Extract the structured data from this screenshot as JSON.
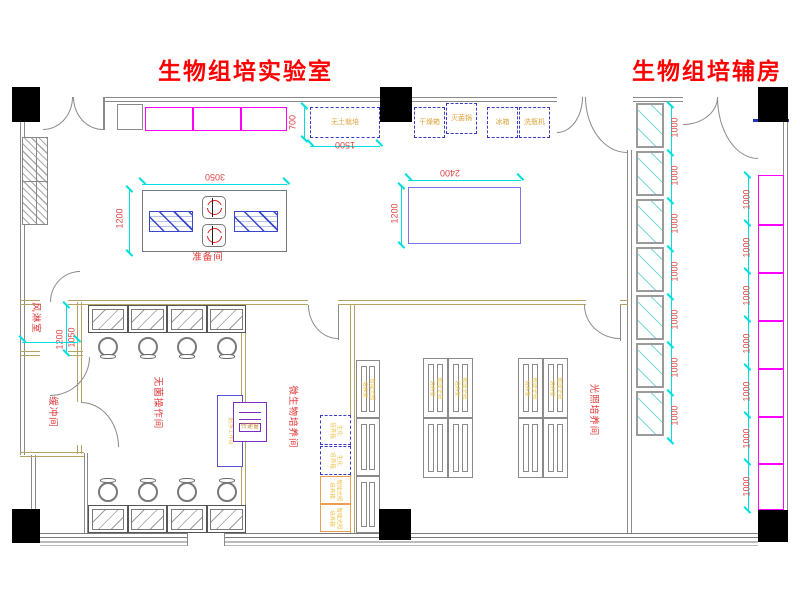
{
  "titles": {
    "main_lab": "生物组培实验室",
    "aux_room": "生物组培辅房"
  },
  "rooms": {
    "prep_room": "准备间",
    "air_shower": "风淋室",
    "buffer_room": "缓冲间",
    "sterile_room": "无菌操作间",
    "micro_room": "微生物培养间",
    "light_room": "光照培养间"
  },
  "equipment": {
    "soilless_culture": "无土栽培",
    "drying_oven": "干燥箱",
    "sterilizer": "灭菌锅",
    "fridge": "冰箱",
    "bottle_washer": "洗瓶机",
    "pass_window": "传递窗",
    "clean_bench": "超净工作台",
    "biochem_incubator_l1": "生化",
    "biochem_incubator_l2": "培养箱",
    "light_incubator_l1": "智能光照",
    "light_incubator_l2": "培养箱",
    "light_rack_l1": "智能光照",
    "light_rack_l2": "培养架"
  },
  "dims": {
    "sink_table_w": "3050",
    "table_h": "1200",
    "plain_table_w": "2400",
    "soilless_w": "1500",
    "soilless_h": "700",
    "air_shower_w": "1200",
    "air_shower_d": "1050",
    "module": "1000"
  },
  "colors": {
    "title_red": "#ff0000",
    "label_red": "#e03535",
    "dim_cyan": "#00dede",
    "wall_gray": "#8a8a8a",
    "partition_tan": "#b5a264",
    "magenta": "#ff00ff",
    "equipment_text_orange": "#dca63f",
    "dashed_blue": "#3a3ac8",
    "purple": "#7b2fbe",
    "incubator_orange": "#eca04e",
    "table_blue": "#7878e8",
    "hatch_blue": "#3848c8"
  }
}
